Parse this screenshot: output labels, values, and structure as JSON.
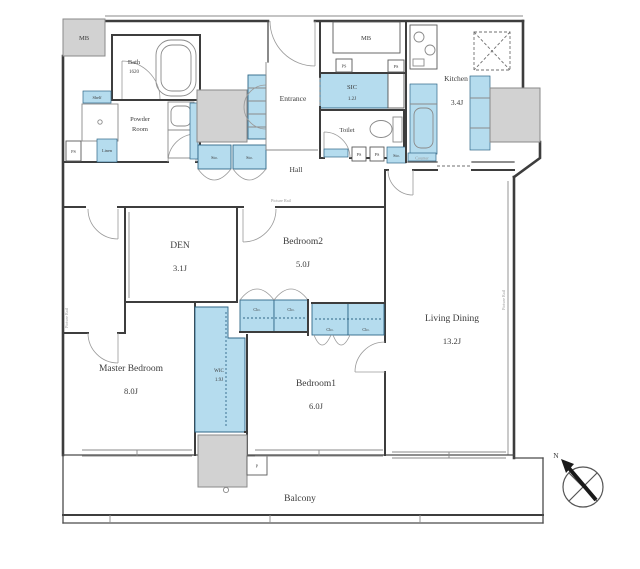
{
  "floorplan": {
    "type": "apartment-floor-plan",
    "compass": {
      "north": "N"
    },
    "rooms": {
      "bath": {
        "name": "Bath",
        "size": "1620"
      },
      "powder_room": {
        "line1": "Powder",
        "line2": "Room"
      },
      "entrance": {
        "name": "Entrance"
      },
      "sic": {
        "name": "SIC",
        "size": "1.2J"
      },
      "toilet": {
        "name": "Toilet"
      },
      "kitchen": {
        "name": "Kitchen",
        "size": "3.4J"
      },
      "hall": {
        "name": "Hall"
      },
      "den": {
        "name": "DEN",
        "size": "3.1J"
      },
      "bedroom2": {
        "name": "Bedroom2",
        "size": "5.0J"
      },
      "living_dining": {
        "name": "Living Dining",
        "size": "13.2J"
      },
      "master_bedroom": {
        "name": "Master Bedroom",
        "size": "8.0J"
      },
      "wic": {
        "name": "WIC",
        "size": "1.9J"
      },
      "bedroom1": {
        "name": "Bedroom1",
        "size": "6.0J"
      },
      "balcony": {
        "name": "Balcony"
      }
    },
    "fixtures": {
      "meter_box": "MB",
      "pipe_space": "PS",
      "storage": "Sto.",
      "closet": "Clo.",
      "linen": "Linen",
      "shelf": "Shelf",
      "counter": "Counter",
      "pipe_duct": "P",
      "picture_rail": "Picture Rail"
    },
    "colors": {
      "fixture_fill": "#b5dcee",
      "fixture_stroke": "#2e6687",
      "column_fill": "#d2d2d2",
      "wall": "#3d3d3d",
      "background": "#ffffff"
    }
  }
}
